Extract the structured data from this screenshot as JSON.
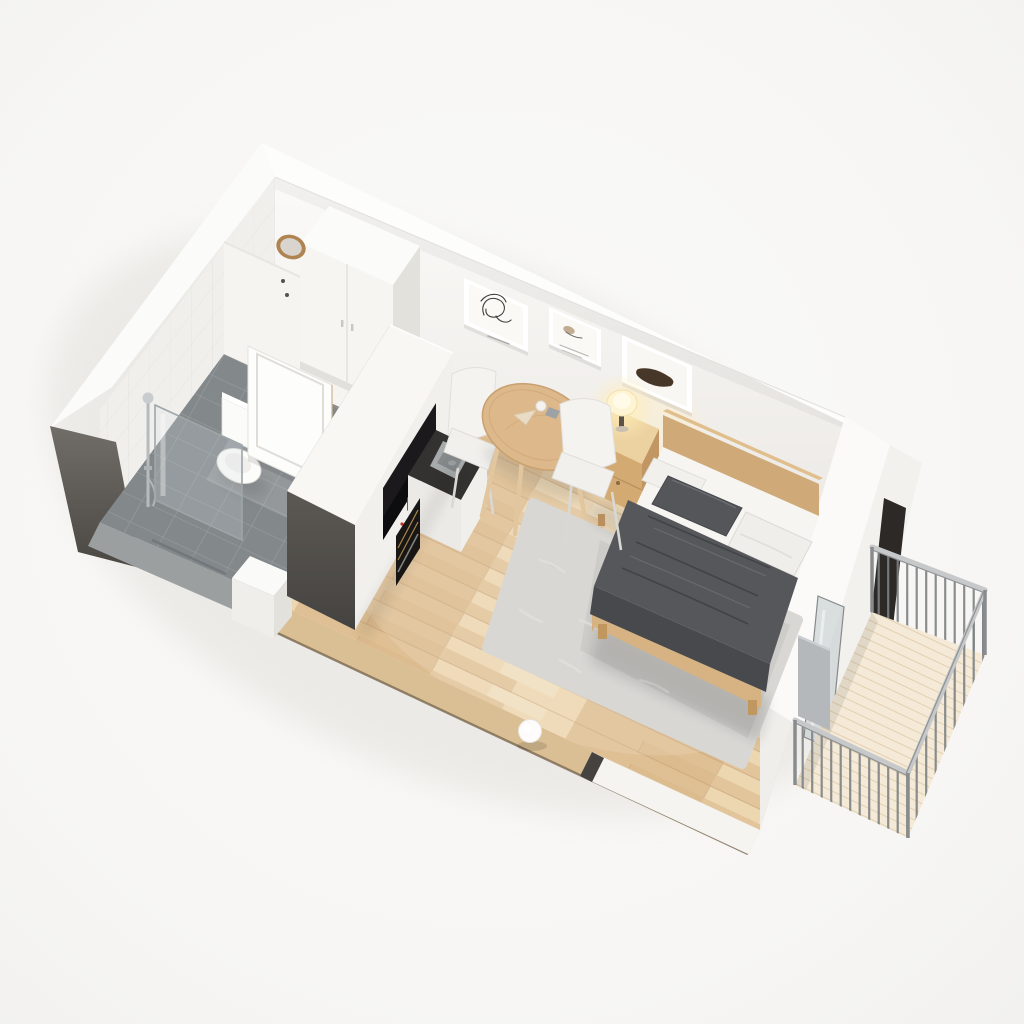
{
  "scene": {
    "title": "Isometric 3D cutaway floor plan of a studio apartment",
    "style": "photorealistic architectural render viewed from above the south-west corner",
    "background_color": "#f7f6f4",
    "rooms": [
      {
        "name": "Entry hall",
        "items": [
          "white two-door wardrobe",
          "round wood-framed wall mirror",
          "wall hooks",
          "open white panel door"
        ]
      },
      {
        "name": "Bathroom",
        "items": [
          "walk-in shower with glass panel",
          "chrome shower column",
          "toilet with cistern",
          "grey tile floor",
          "linear floor drain",
          "white storage cube"
        ]
      },
      {
        "name": "Kitchenette",
        "items": [
          "tall white cabinet block with dark grey side walls",
          "black counter niche",
          "stainless steel sink",
          "black cooktop",
          "oven with brass trim",
          "white kettle",
          "red canister",
          "peach cup"
        ]
      },
      {
        "name": "Living and sleeping area",
        "items": [
          "light oak plank floor",
          "double bed with light wood frame",
          "white bedding",
          "dark grey throw blanket",
          "dark grey pillow",
          "two white pillows",
          "wood nightstand with drawer",
          "glowing table lamp",
          "grey shag area rug",
          "round wood dining table",
          "two white shell chairs",
          "cup, box and napkin on table",
          "three framed artworks",
          "white sphere floor lamp"
        ]
      },
      {
        "name": "Balcony",
        "items": [
          "light wood plank deck",
          "grey metal railing with vertical balusters",
          "sliding glass door",
          "grey privacy panel"
        ]
      }
    ],
    "artworks": [
      {
        "name": "frame-1",
        "subject": "abstract one-line face drawing"
      },
      {
        "name": "frame-2",
        "subject": "small beige sketch with caption lines"
      },
      {
        "name": "frame-3",
        "subject": "dark bottle still-life"
      }
    ],
    "palette": {
      "background": "#f7f6f4",
      "wall_white": "#f6f4f1",
      "wall_cut_dark": "#56534e",
      "wood_floor": "#e5c9a0",
      "bathroom_tile": "#83888b",
      "rug_grey": "#d8d7d4",
      "blanket_grey": "#55575b",
      "furniture_wood": "#d8b586",
      "metal_grey": "#9aa0a3",
      "lamp_glow": "#ffedb8",
      "accent_red": "#c23b2a",
      "art_dark": "#473729"
    }
  }
}
